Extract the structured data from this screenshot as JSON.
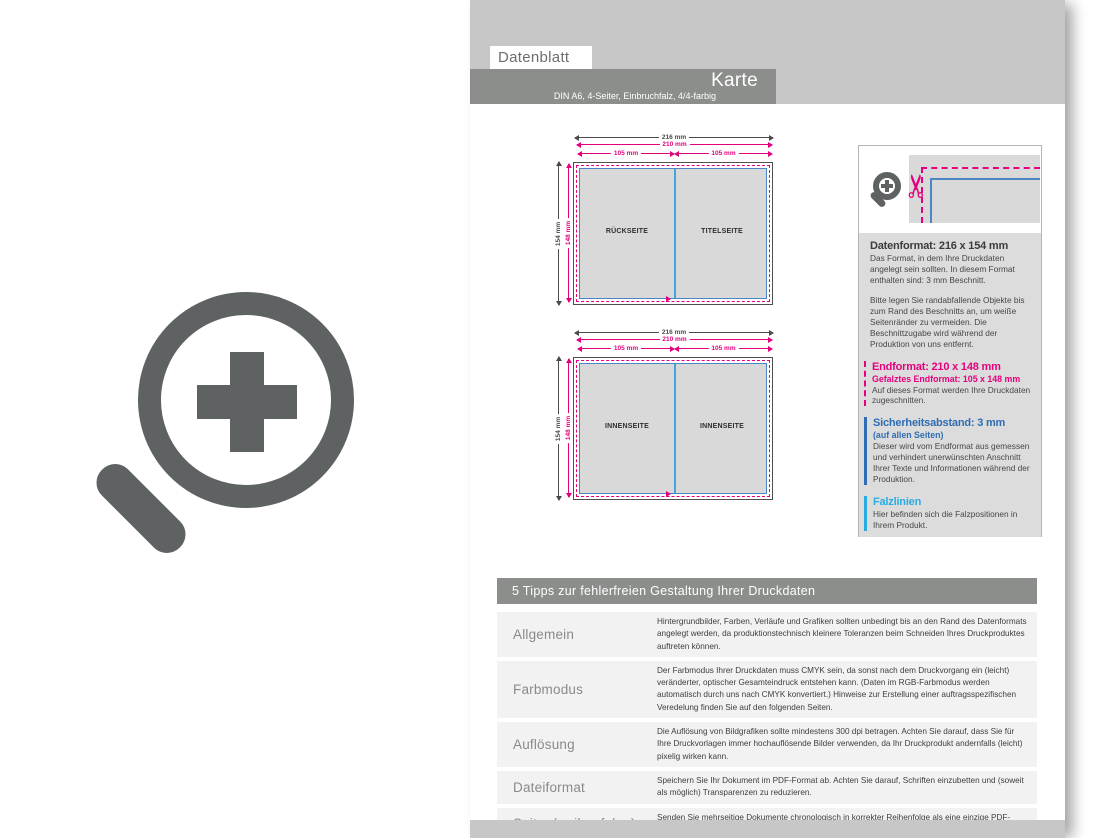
{
  "header": {
    "sheet_label": "Datenblatt",
    "product_title": "Karte",
    "product_subtitle": "DIN A6, 4-Seiter, Einbruchfalz, 4/4-farbig"
  },
  "diagrams": [
    {
      "total_width": "216 mm",
      "end_width": "210 mm",
      "half_width_left": "105 mm",
      "half_width_right": "105 mm",
      "total_height": "154 mm",
      "end_height": "148 mm",
      "panel_left": "RÜCKSEITE",
      "panel_right": "TITELSEITE"
    },
    {
      "total_width": "216 mm",
      "end_width": "210 mm",
      "half_width_left": "105 mm",
      "half_width_right": "105 mm",
      "total_height": "154 mm",
      "end_height": "148 mm",
      "panel_left": "INNENSEITE",
      "panel_right": "INNENSEITE"
    }
  ],
  "info_panel": {
    "scissors_icon": "✂",
    "datenformat": {
      "title": "Datenformat: 216 x 154 mm",
      "p1": "Das Format, in dem Ihre Druckdaten angelegt sein sollten. In diesem Format enthalten sind: 3 mm Beschnitt.",
      "p2": "Bitte legen Sie randabfallende Objekte bis zum Rand des Beschnitts an, um weiße Seitenränder zu vermeiden. Die Beschnittzugabe wird während der Produktion von uns entfernt."
    },
    "endformat": {
      "title": "Endformat: 210 x 148 mm",
      "subtitle": "Gefalztes Endformat: 105 x 148 mm",
      "p": "Auf dieses Format werden Ihre Druckdaten zugeschnitten."
    },
    "sicherheitsabstand": {
      "title": "Sicherheitsabstand: 3 mm",
      "subtitle": "(auf allen Seiten)",
      "p": "Dieser wird vom Endformat aus gemessen und verhindert unerwünschten Anschnitt Ihrer Texte und Informationen während der Produktion."
    },
    "falzlinien": {
      "title": "Falzlinien",
      "p": "Hier befinden sich die Falzpositionen in Ihrem Produkt."
    }
  },
  "tips_table": {
    "title": "5 Tipps zur fehlerfreien Gestaltung Ihrer Druckdaten",
    "rows": [
      {
        "label": "Allgemein",
        "text": "Hintergrundbilder, Farben, Verläufe und Grafiken sollten unbedingt bis an den Rand des Datenformats angelegt werden, da produktionstechnisch kleinere Toleranzen beim Schneiden Ihres Druckproduktes auftreten können."
      },
      {
        "label": "Farbmodus",
        "text": "Der Farbmodus Ihrer Druckdaten muss CMYK sein, da sonst nach dem Druckvorgang ein (leicht) veränderter, optischer Gesamteindruck entstehen kann. (Daten im RGB-Farbmodus werden automatisch durch uns nach CMYK konvertiert.) Hinweise zur Erstellung einer auftragsspezifischen Veredelung finden Sie auf den folgenden Seiten."
      },
      {
        "label": "Auflösung",
        "text": "Die Auflösung von Bildgrafiken sollte mindestens 300 dpi betragen. Achten Sie darauf, dass Sie für Ihre Druckvorlagen immer hochauflösende Bilder verwenden, da Ihr Druckprodukt andernfalls (leicht) pixelig wirken kann."
      },
      {
        "label": "Dateiformat",
        "text": "Speichern Sie Ihr Dokument im PDF-Format ab. Achten Sie darauf, Schriften einzubetten und (soweit als möglich) Transparenzen zu reduzieren."
      },
      {
        "label": "Seiten(-reihenfolge)",
        "text": "Senden Sie mehrseitige Dokumente chronologisch in korrekter Reihenfolge als eine einzige PDF-Datei oder benennen Sie Einzeldokumente entsprechend mit fortlaufenden Seitennummern."
      }
    ]
  },
  "colors": {
    "magenta": "#e5007d",
    "blue": "#2e6db4",
    "cyan": "#2aabe2",
    "bar_gray": "#8b8e8b",
    "light_gray": "#c7c7c7",
    "icon_gray": "#5f6262"
  }
}
